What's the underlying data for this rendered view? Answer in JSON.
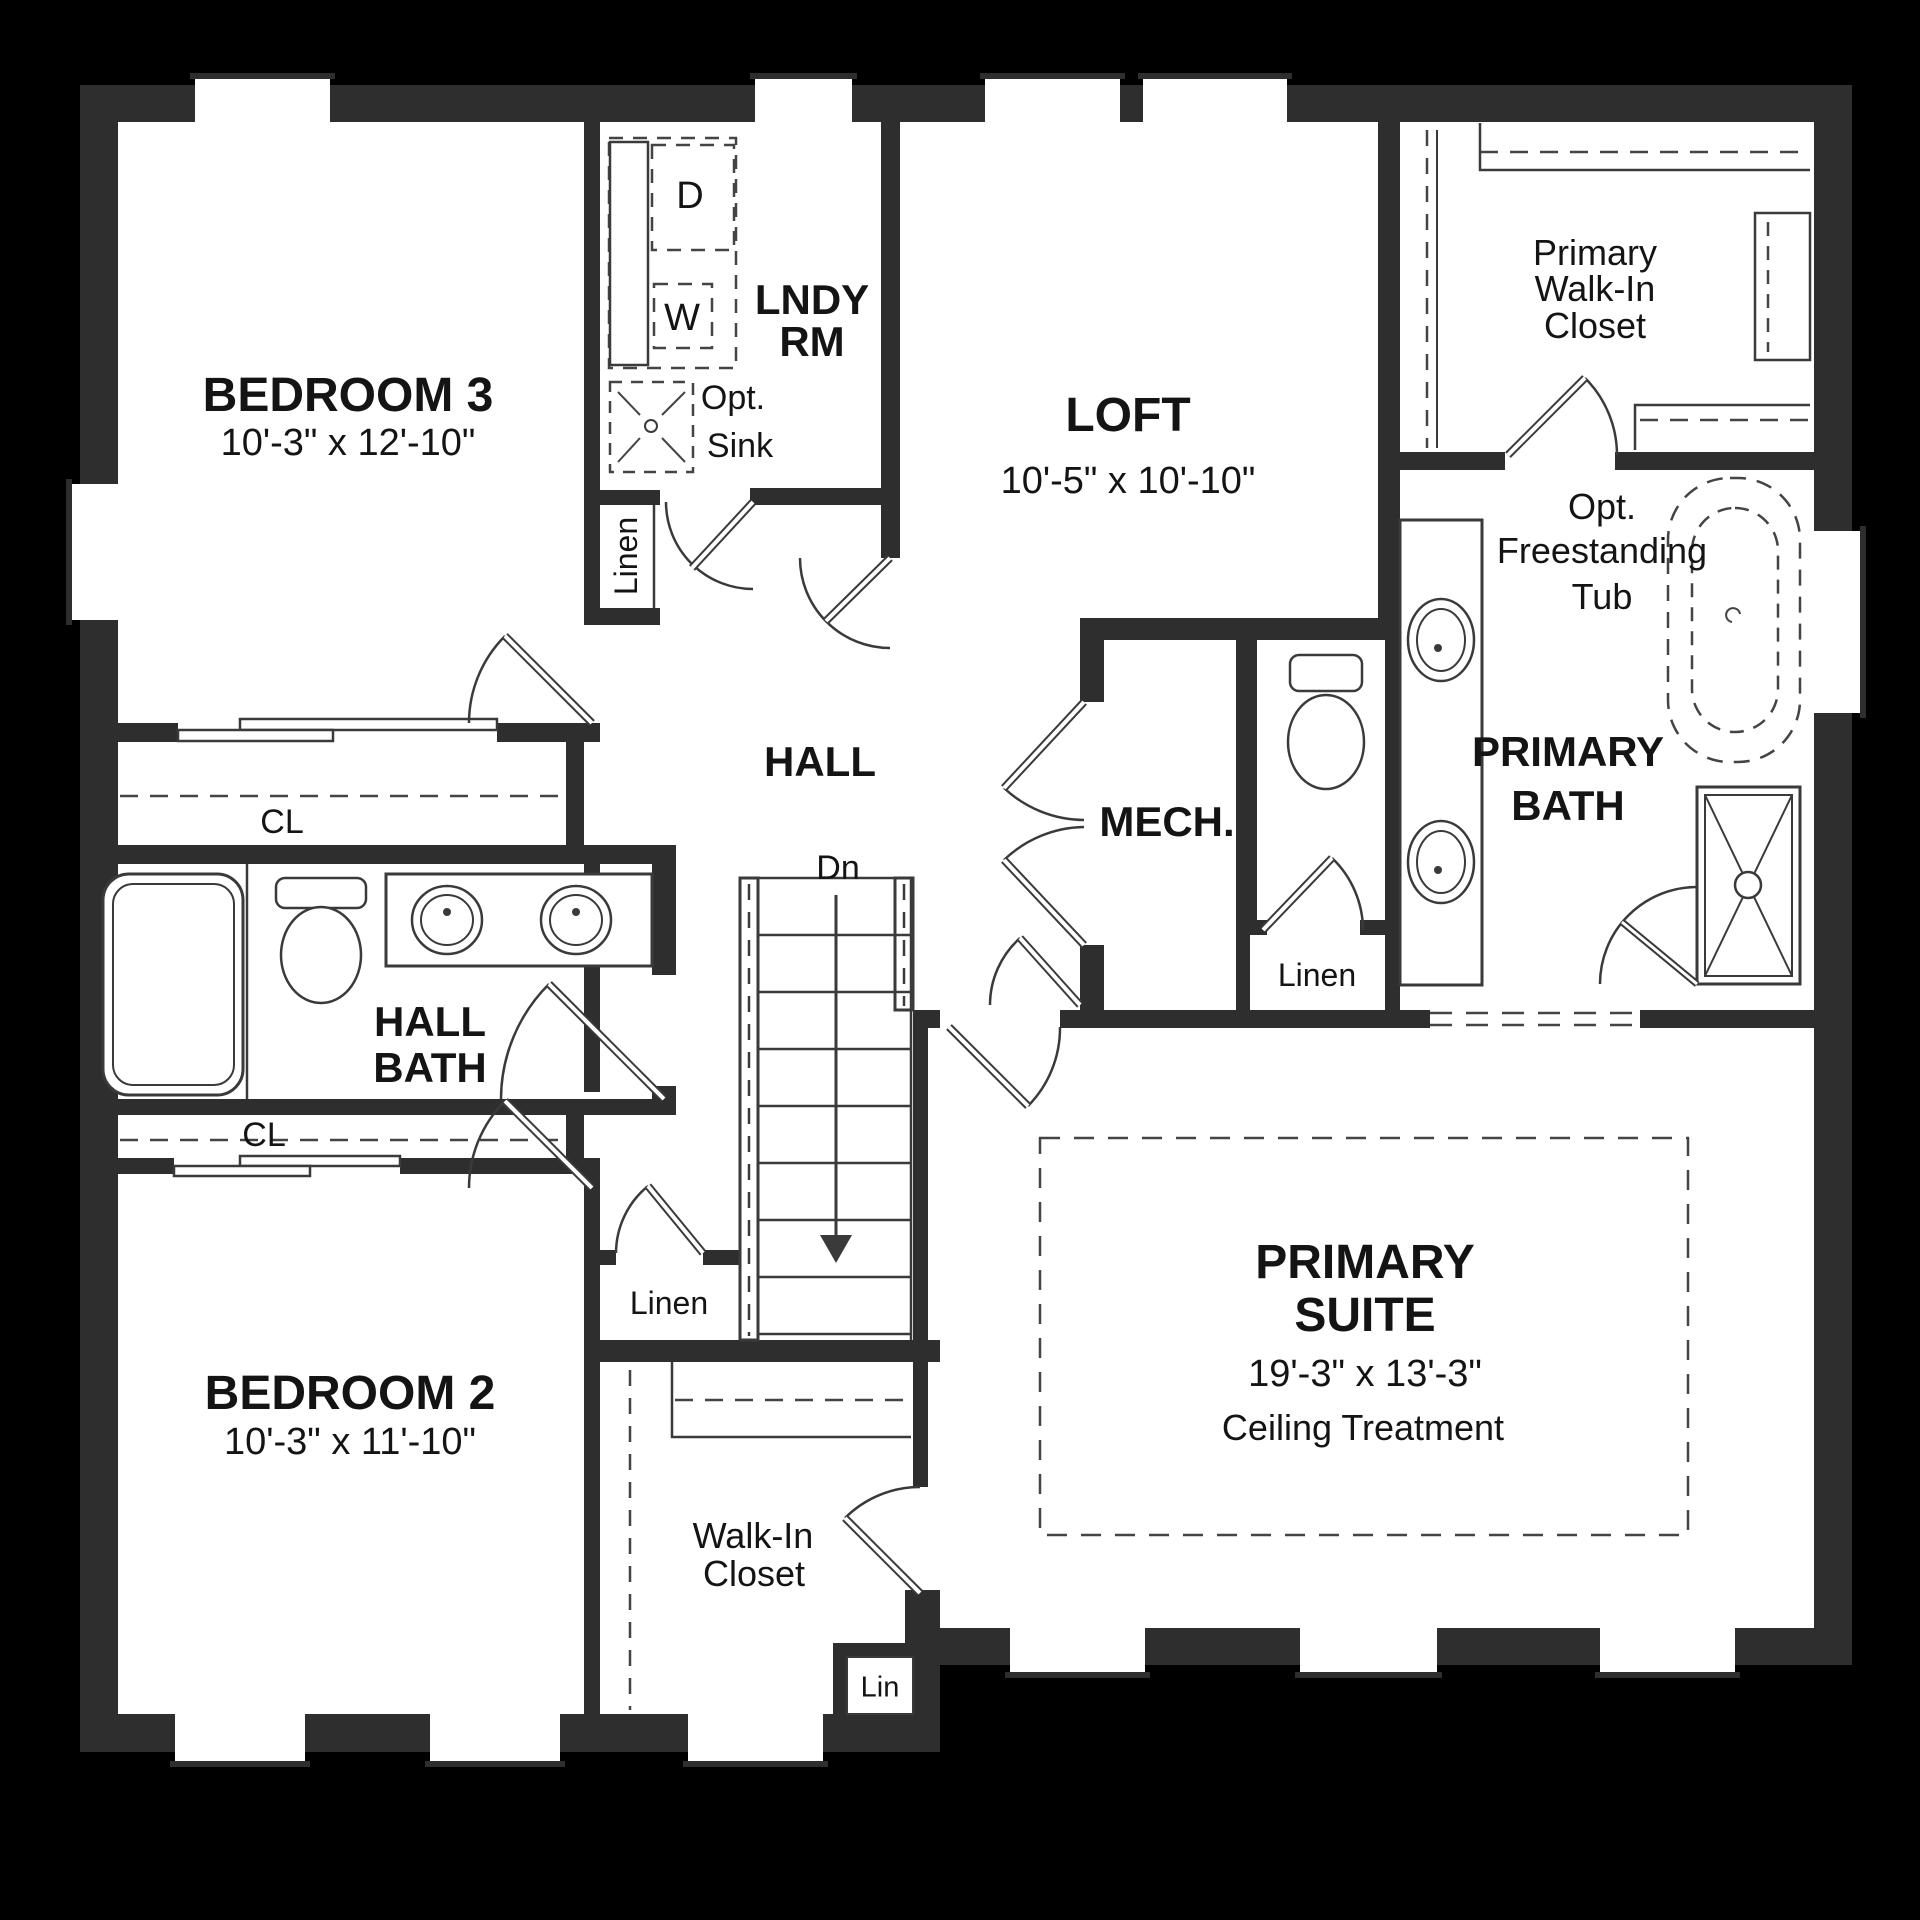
{
  "plan": {
    "type": "second-floor residential floor plan",
    "colors": {
      "background": "#000000",
      "wall": "#2e2e2e",
      "floor": "#ffffff",
      "line": "#3a3a3a",
      "text": "#141414"
    },
    "rooms": {
      "bedroom3": {
        "name": "BEDROOM 3",
        "dims": "10'-3\" x 12'-10\""
      },
      "laundry": {
        "name_line1": "LNDY",
        "name_line2": "RM",
        "dryer": "D",
        "washer": "W",
        "sink_line1": "Opt.",
        "sink_line2": "Sink",
        "linen": "Linen"
      },
      "loft": {
        "name": "LOFT",
        "dims": "10'-5\" x 10'-10\""
      },
      "primary_closet": {
        "line1": "Primary",
        "line2": "Walk-In",
        "line3": "Closet"
      },
      "primary_bath": {
        "name_line1": "PRIMARY",
        "name_line2": "BATH",
        "tub_line1": "Opt.",
        "tub_line2": "Freestanding",
        "tub_line3": "Tub",
        "linen": "Linen"
      },
      "hall": {
        "name": "HALL",
        "stairs": "Dn"
      },
      "mech": {
        "name": "MECH."
      },
      "hall_bath": {
        "name_line1": "HALL",
        "name_line2": "BATH",
        "closet_upper": "CL",
        "closet_lower": "CL"
      },
      "bedroom2": {
        "name": "BEDROOM 2",
        "dims": "10'-3\" x 11'-10\""
      },
      "walk_in_closet": {
        "line1": "Walk-In",
        "line2": "Closet",
        "lin": "Lin",
        "linen": "Linen"
      },
      "primary_suite": {
        "name_line1": "PRIMARY",
        "name_line2": "SUITE",
        "dims": "19'-3\" x 13'-3\"",
        "note": "Ceiling Treatment"
      }
    }
  }
}
